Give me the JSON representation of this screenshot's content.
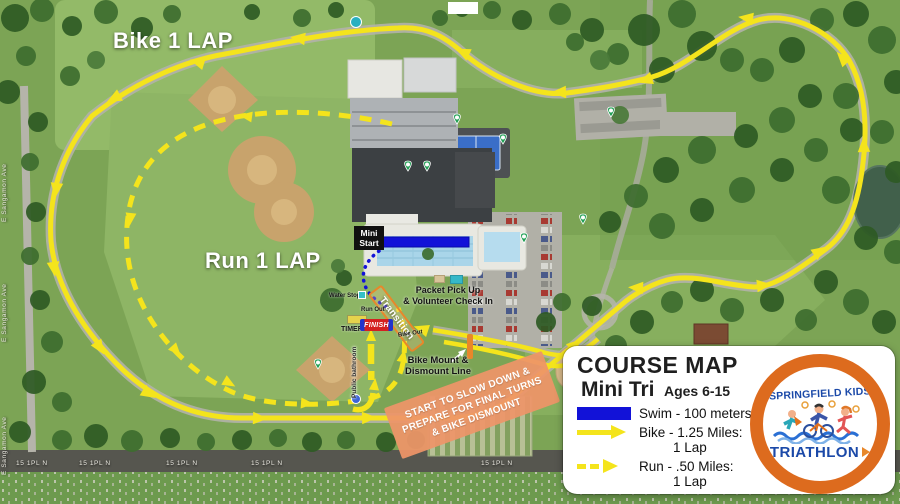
{
  "map_labels": {
    "bike_lap": "Bike 1 LAP",
    "run_lap": "Run 1 LAP",
    "mini_start_line1": "Mini",
    "mini_start_line2": "Start",
    "packet_line1": "Packet Pick Up",
    "packet_line2": "& Volunteer Check In",
    "transition": "Transition",
    "water_stop": "Water Stop",
    "run_out": "Run Out",
    "bike_out": "Bike Out",
    "timer": "TIMER",
    "finish": "FINISH",
    "public_bathroom": "Public bathroom",
    "bike_mount_line1": "Bike Mount &",
    "bike_mount_line2": "Dismount Line",
    "slowdown_line1": "START TO SLOW DOWN &",
    "slowdown_line2": "PREPARE FOR FINAL TURNS",
    "slowdown_line3": "& BIKE DISMOUNT",
    "street_left": "E Sangamon Ave",
    "street_bottom": "15 1PL N"
  },
  "legend": {
    "title": "COURSE MAP",
    "subtitle": "Mini Tri",
    "ages": "Ages 6-15",
    "items": [
      {
        "label": "Swim - 100 meters"
      },
      {
        "label": "Bike - 1.25 Miles:",
        "label2": "1 Lap"
      },
      {
        "label": "Run - .50 Miles:",
        "label2": "1 Lap"
      }
    ]
  },
  "logo": {
    "line1": "SPRINGFIELD KIDS",
    "line2": "TRIATHLON"
  },
  "colors": {
    "route_yellow": "#f4e41c",
    "swim_blue": "#1212d8",
    "orange": "#e8872a",
    "salmon": "#ee9468",
    "legend_bg": "#ffffff"
  }
}
